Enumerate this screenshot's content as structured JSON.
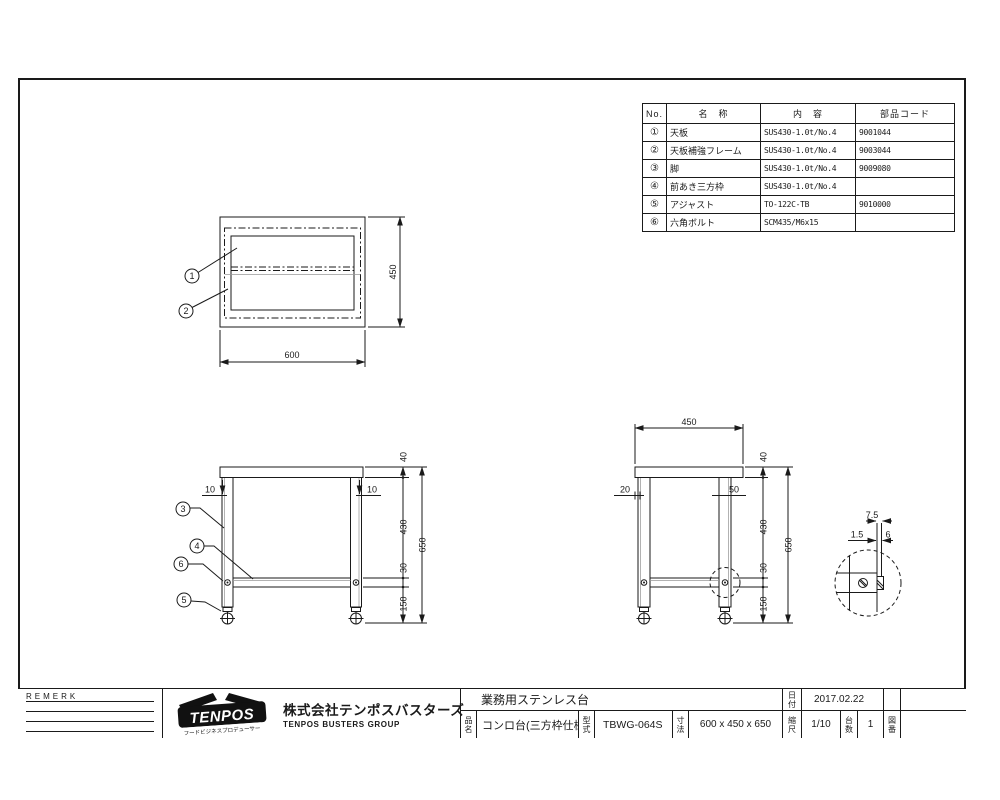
{
  "sheet": {
    "parts_table": {
      "headers": {
        "no": "No.",
        "name": "名　称",
        "spec": "内　容",
        "code": "部品コード"
      },
      "rows": [
        {
          "no": "①",
          "name": "天板",
          "spec": "SUS430-1.0t/No.4",
          "code": "9001044"
        },
        {
          "no": "②",
          "name": "天板補強フレーム",
          "spec": "SUS430-1.0t/No.4",
          "code": "9003044"
        },
        {
          "no": "③",
          "name": "脚",
          "spec": "SUS430-1.0t/No.4",
          "code": "9009080"
        },
        {
          "no": "④",
          "name": "前あき三方枠",
          "spec": "SUS430-1.0t/No.4",
          "code": ""
        },
        {
          "no": "⑤",
          "name": "アジャスト",
          "spec": "TO-122C-TB",
          "code": "9010000"
        },
        {
          "no": "⑥",
          "name": "六角ボルト",
          "spec": "SCM435/M6x15",
          "code": ""
        }
      ]
    },
    "views": {
      "top": {
        "b1": "1",
        "b2": "2",
        "width": "600",
        "depth": "450"
      },
      "front": {
        "b3": "3",
        "b4": "4",
        "b5": "5",
        "b6": "6",
        "inset_l": "10",
        "inset_r": "10",
        "top": "40",
        "leg": "430",
        "frame": "30",
        "foot": "150",
        "total": "650"
      },
      "side": {
        "width": "450",
        "edge": "20",
        "leg_w": "50",
        "top": "40",
        "leg": "430",
        "frame": "30",
        "foot": "150",
        "total": "650"
      },
      "detail": {
        "a": "7.5",
        "b": "1.5",
        "c": "6"
      }
    },
    "title_block": {
      "remark_label": "REMERK",
      "logo_text": "TENPOS",
      "logo_tagline": "フードビジネスプロデューサー",
      "company_name": "株式会社テンポスバスターズ",
      "company_sub": "TENPOS BUSTERS GROUP",
      "product_category": "業務用ステンレス台",
      "name_label": "品名",
      "product_name": "コンロ台(三方枠仕様)",
      "model_label": "型式",
      "model": "TBWG-064S",
      "size_label": "寸法",
      "size": "600 x 450 x 650",
      "date_label": "日付",
      "date": "2017.02.22",
      "scale_label": "縮尺",
      "scale": "1/10",
      "qty_label": "台数",
      "qty": "1",
      "dwgno_label": "図番"
    }
  }
}
